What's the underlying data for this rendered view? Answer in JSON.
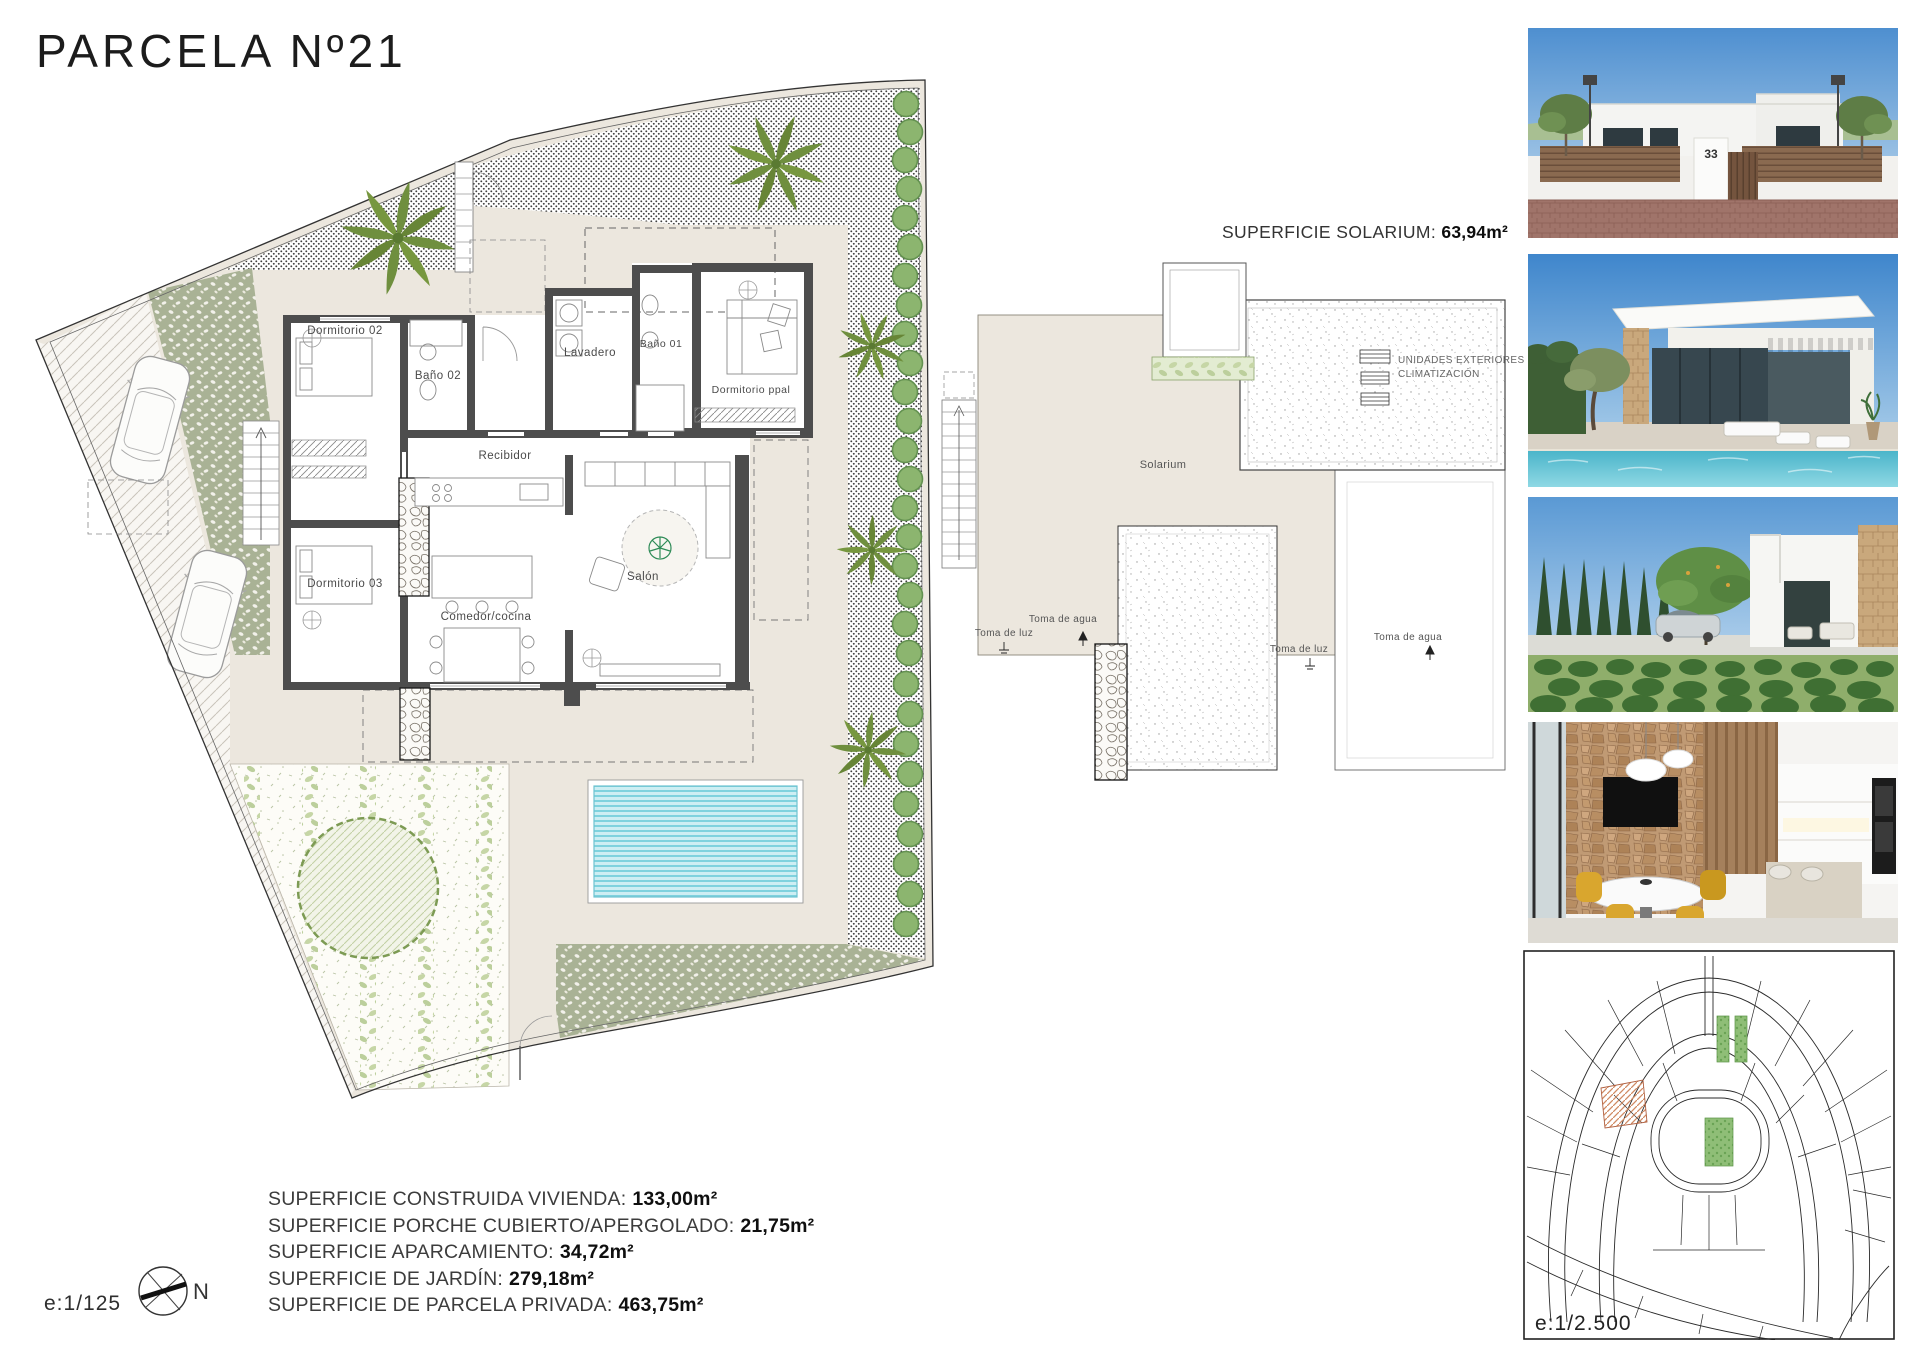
{
  "title": "PARCELA Nº21",
  "floor_plan": {
    "scale": "e:1/125",
    "compass": "N",
    "rooms": {
      "dormitorio02": "Dormitorio 02",
      "bano02": "Baño 02",
      "lavadero": "Lavadero",
      "bano01": "Baño 01",
      "dormitorio_ppal": "Dormitorio ppal",
      "recibidor": "Recibidor",
      "dormitorio03": "Dormitorio 03",
      "comedor_cocina": "Comedor/cocina",
      "salon": "Salón"
    }
  },
  "solarium_plan": {
    "heading_label": "SUPERFICIE SOLARIUM:",
    "heading_value": "63,94m²",
    "room_label": "Solarium",
    "ac_units_line1": "UNIDADES EXTERIORES",
    "ac_units_line2": "CLIMATIZACIÓN",
    "water_tap_label": "Toma de agua",
    "light_tap_label": "Toma de luz"
  },
  "surface_summary": {
    "items": [
      {
        "label": "SUPERFICIE CONSTRUIDA VIVIENDA:",
        "value": "133,00m²"
      },
      {
        "label": "SUPERFICIE PORCHE CUBIERTO/APERGOLADO:",
        "value": "21,75m²"
      },
      {
        "label": "SUPERFICIE APARCAMIENTO:",
        "value": "34,72m²"
      },
      {
        "label": "SUPERFICIE DE JARDÍN:",
        "value": "279,18m²"
      },
      {
        "label": "SUPERFICIE DE PARCELA PRIVADA:",
        "value": "463,75m²"
      }
    ]
  },
  "photos": {
    "house_number": "33"
  },
  "site_plan": {
    "scale": "e:1/2.500"
  },
  "colors": {
    "pool": "#7fd2de",
    "terrace_beige": "#ece7de",
    "garden_green": "#a9b295",
    "bush_green": "#8cb56f",
    "palm_green": "#6f8f3e",
    "wall_gray": "#4d4d4d",
    "parcel_hatch_orange": "#d08a62"
  }
}
